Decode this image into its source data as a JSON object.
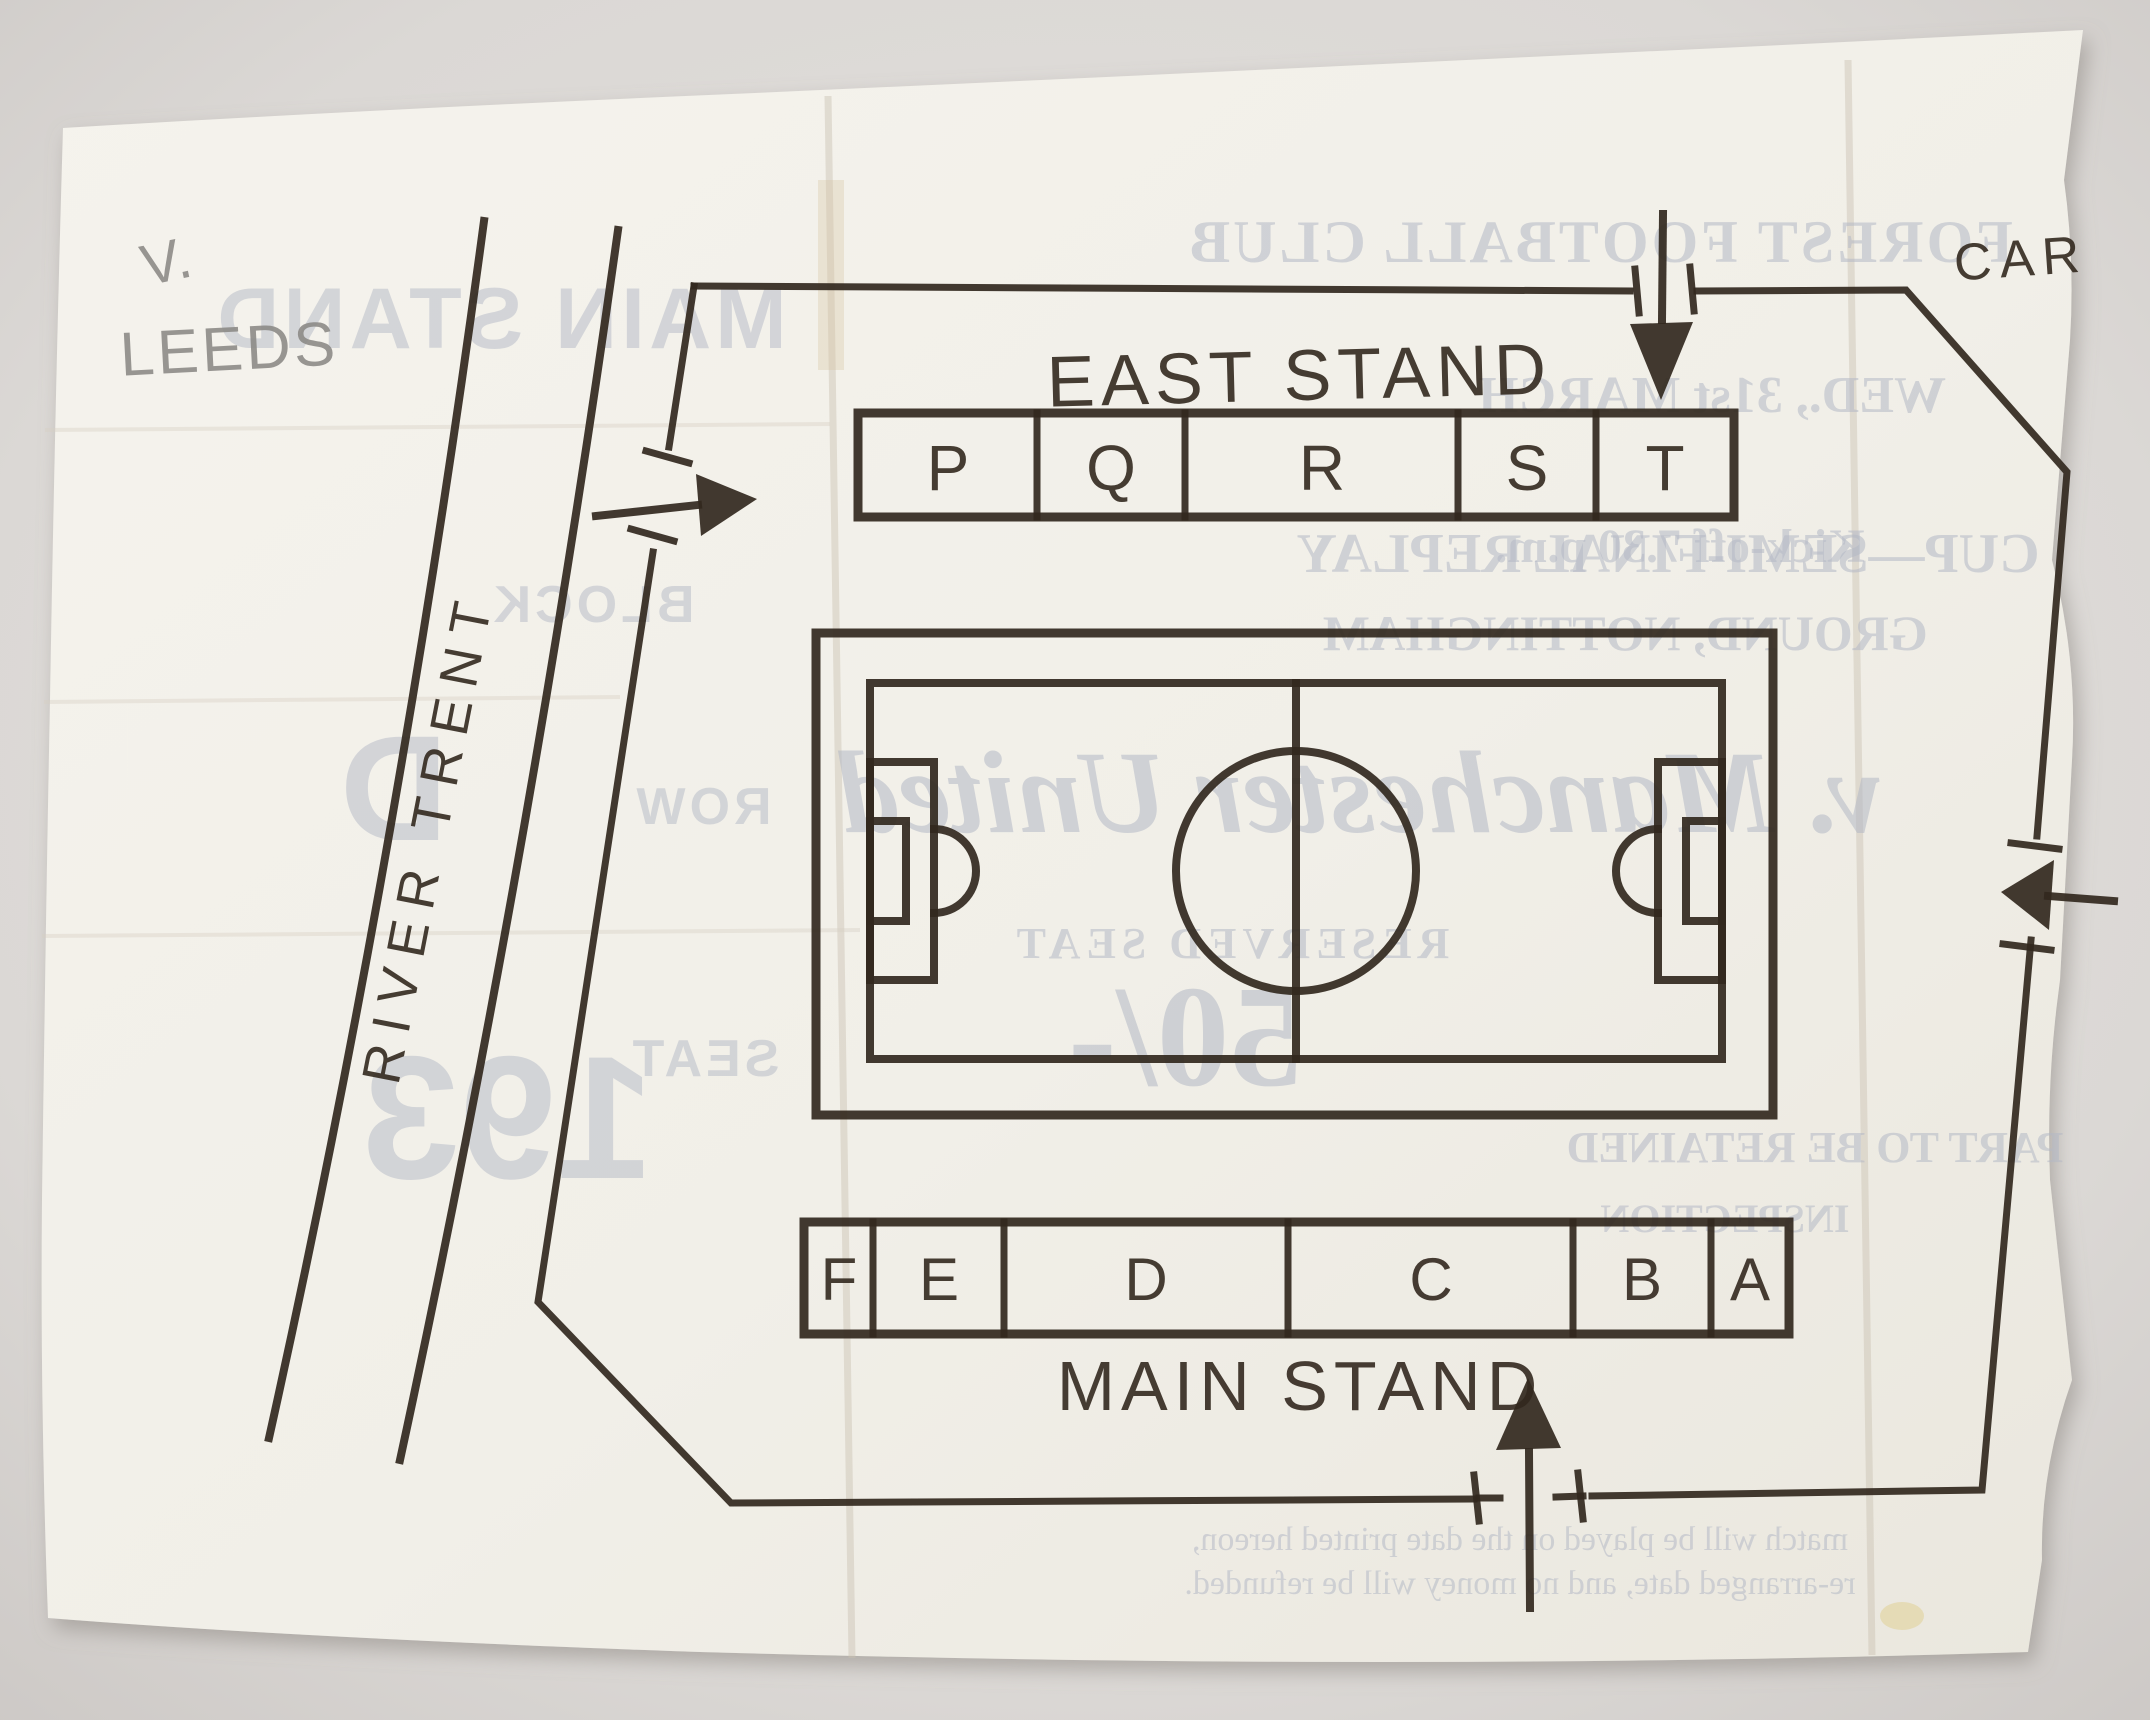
{
  "handwriting": {
    "versus": "V.",
    "opponent": "LEEDS"
  },
  "map": {
    "car_park": "CAR",
    "east_stand_label": "EAST STAND",
    "east_sections": [
      "P",
      "Q",
      "R",
      "S",
      "T"
    ],
    "main_stand_label": "MAIN STAND",
    "main_sections": [
      "F",
      "E",
      "D",
      "C",
      "B",
      "A"
    ],
    "river_label": "RIVER TRENT"
  },
  "ghost": {
    "stand": "MAIN STAND",
    "club": "FOREST FOOTBALL CLUB",
    "date": "WED., 31st MARCH",
    "kickoff": "Kick-off 7.30 p.m.",
    "competition": "CUP—SEMI-FINAL REPLAY",
    "ground": "GROUND, NOTTINGHAM",
    "fixture": "v. Manchester United",
    "reserved": "RESERVED SEAT",
    "price": "50/-",
    "block_label": "BLOCK",
    "block_value": "D",
    "row_label": "ROW",
    "seat_label": "SEAT",
    "seat_value": "193",
    "retained": "PART TO BE RETAINED",
    "inspection": "INSPECTION",
    "fineprint1": "match will be played on the date printed hereon,",
    "fineprint2": "re-arranged date, and no money will be refunded."
  }
}
